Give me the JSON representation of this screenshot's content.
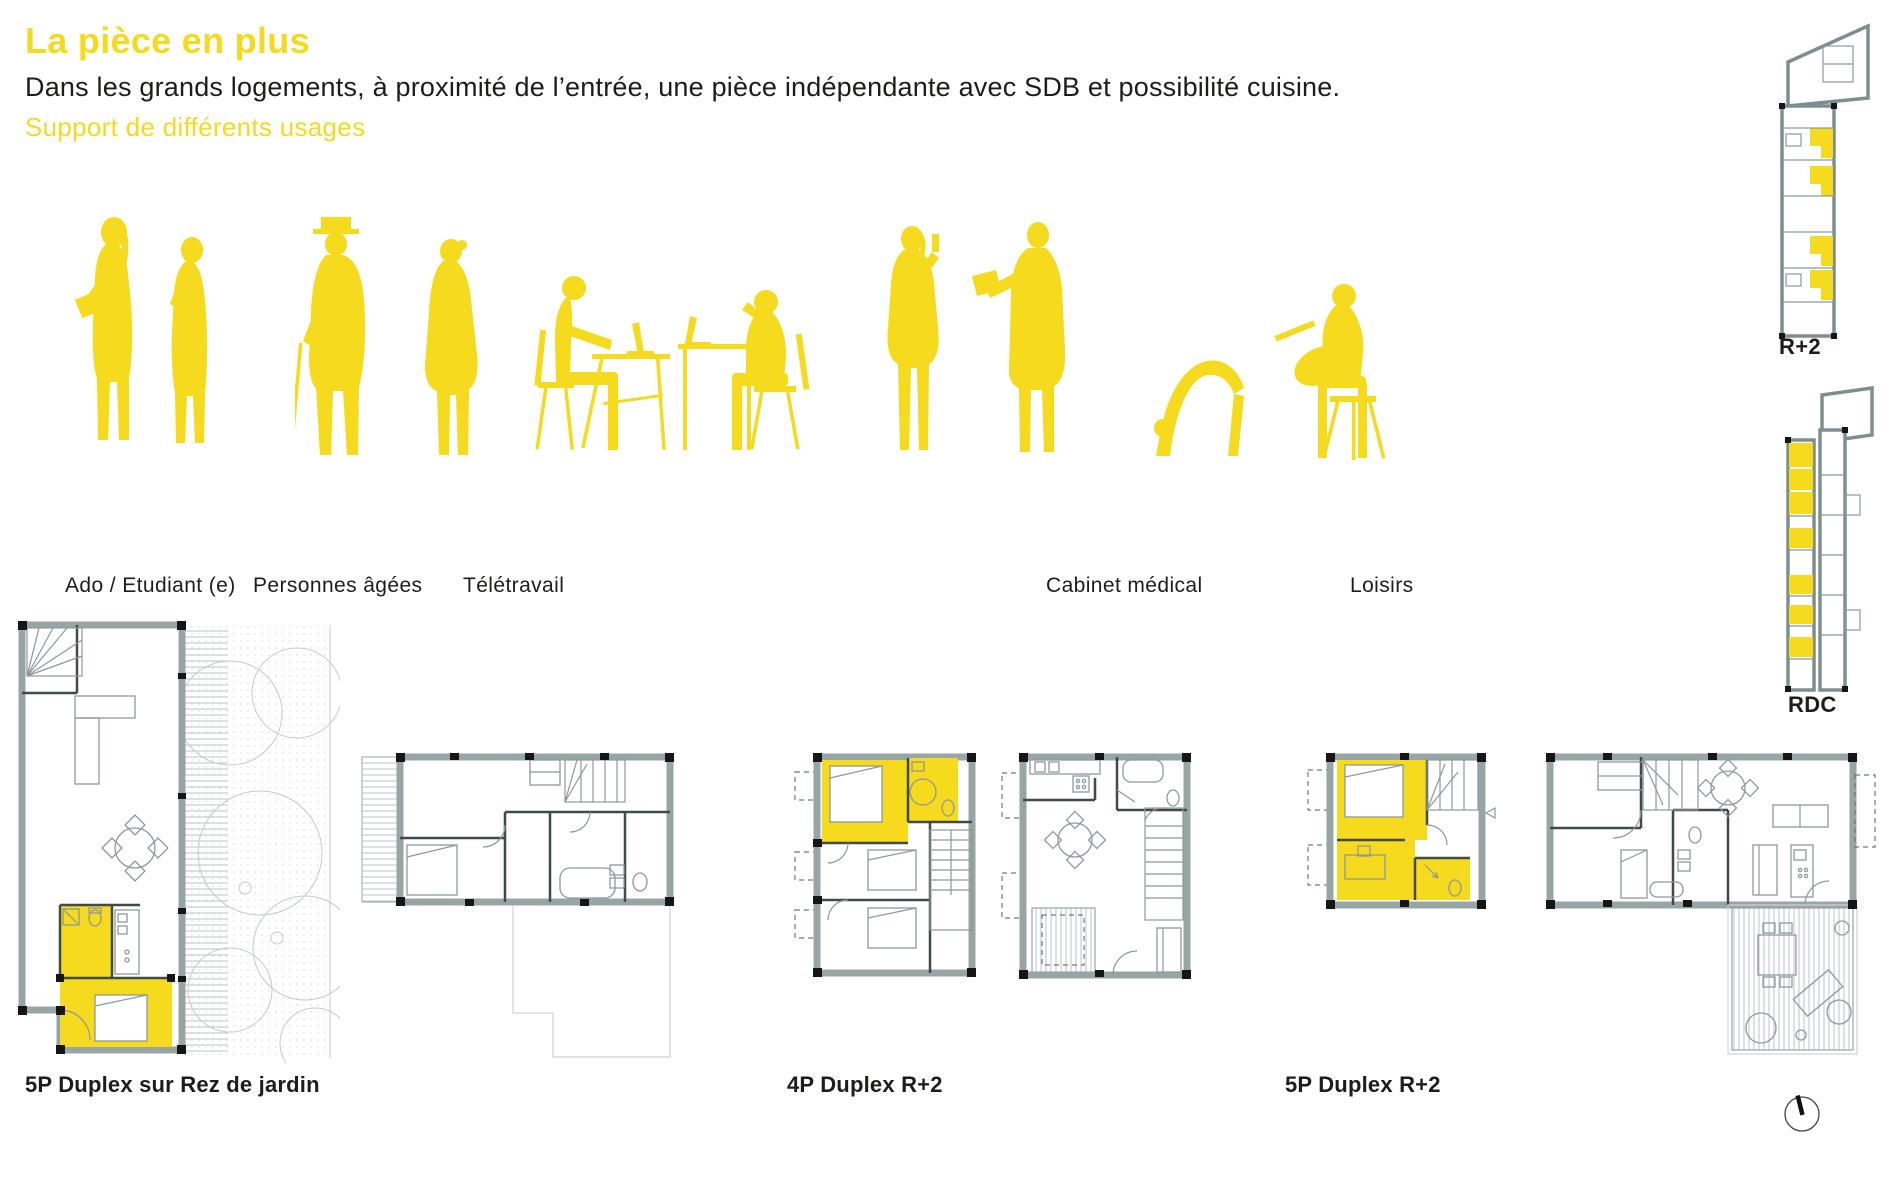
{
  "page": {
    "title": "La pièce en plus",
    "subtitle": "Dans les grands logements, à proximité de l’entrée, une pièce indépendante avec SDB et possibilité cuisine.",
    "tagline": "Support de différents usages"
  },
  "colors": {
    "accent": "#F5DA1E",
    "text": "#1d1d1b",
    "wall": "#97a6a4"
  },
  "usages": {
    "items": [
      {
        "id": "ado-etudiant",
        "label": "Ado / Etudiant (e)"
      },
      {
        "id": "personnes-agees",
        "label": "Personnes âgées"
      },
      {
        "id": "teletravail",
        "label": "Télétravail"
      },
      {
        "id": "cabinet-medical",
        "label": "Cabinet médical"
      },
      {
        "id": "loisirs",
        "label": "Loisirs"
      }
    ]
  },
  "key_plans": {
    "upper_label": "R+2",
    "ground_label": "RDC"
  },
  "floor_plans": {
    "plan1_label": "5P Duplex sur Rez de jardin",
    "plan2_label": "4P Duplex R+2",
    "plan3_label": "5P Duplex R+2"
  }
}
